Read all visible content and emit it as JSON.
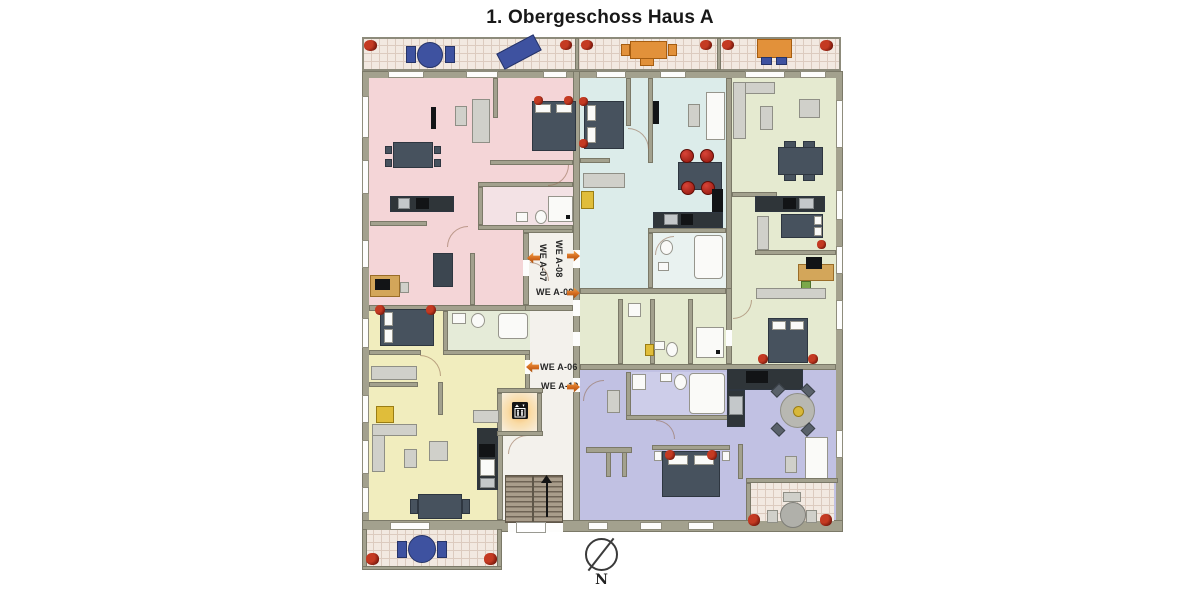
{
  "title": "1. Obergeschoss Haus A",
  "compass": {
    "label": "N"
  },
  "corridor_labels": [
    {
      "label": "WE A-07",
      "orientation": "vertical",
      "arrow_direction": "left"
    },
    {
      "label": "WE A-08",
      "orientation": "vertical",
      "arrow_direction": "right"
    },
    {
      "label": "WE A-09",
      "orientation": "horizontal",
      "arrow_direction": "right"
    },
    {
      "label": "WE A-06",
      "orientation": "horizontal",
      "arrow_direction": "left"
    },
    {
      "label": "WE A-10",
      "orientation": "horizontal",
      "arrow_direction": "right"
    }
  ],
  "apartments": [
    {
      "id": "WE A-06",
      "color": "#f1edbe",
      "location": "bottom-left"
    },
    {
      "id": "WE A-07",
      "color": "#f4d5d7",
      "location": "top-left"
    },
    {
      "id": "WE A-08",
      "color": "#dcecea",
      "location": "top-center"
    },
    {
      "id": "WE A-09",
      "color": "#e5ead0",
      "location": "right"
    },
    {
      "id": "WE A-10",
      "color": "#c1c1e3",
      "location": "bottom-center"
    }
  ],
  "colors": {
    "wall": "#a3a18e",
    "corridor": "#f3f1ec",
    "label_arrow": "#d2691e",
    "balcony_tile": "#f2e9e1"
  },
  "icons": {
    "elevator": "elevator-icon",
    "north_arrow": "compass-north-arrow"
  }
}
